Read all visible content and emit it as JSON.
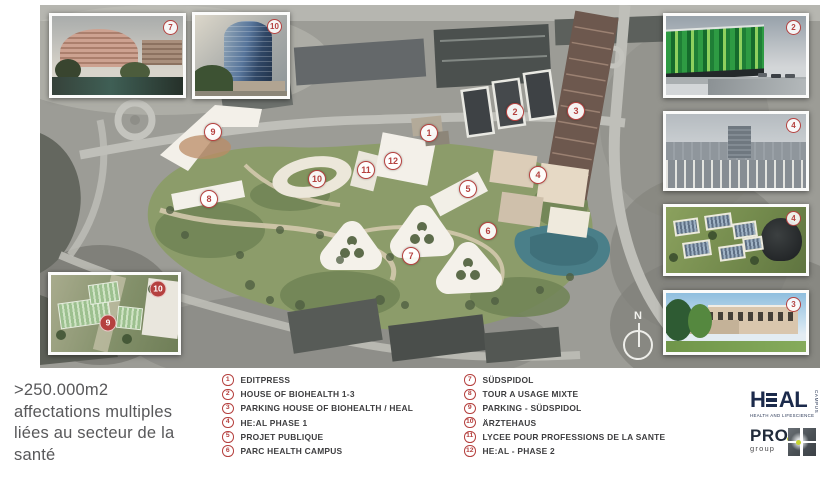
{
  "headline": ">250.000m2 affectations multiples liées au secteur de la santé",
  "legend": {
    "items": [
      {
        "num": "1",
        "label": "EDITPRESS"
      },
      {
        "num": "2",
        "label": "HOUSE OF BIOHEALTH 1-3"
      },
      {
        "num": "3",
        "label": "PARKING HOUSE OF BIOHEALTH / HEAL"
      },
      {
        "num": "4",
        "label": "HE:AL PHASE 1"
      },
      {
        "num": "5",
        "label": "PROJET PUBLIQUE"
      },
      {
        "num": "6",
        "label": "PARC HEALTH CAMPUS"
      },
      {
        "num": "7",
        "label": "SÜDSPIDOL"
      },
      {
        "num": "8",
        "label": "TOUR A USAGE MIXTE"
      },
      {
        "num": "9",
        "label": "PARKING - SÜDSPIDOL"
      },
      {
        "num": "10",
        "label": "ÄRZTEHAUS"
      },
      {
        "num": "11",
        "label": "LYCEE POUR PROFESSIONS DE LA SANTE"
      },
      {
        "num": "12",
        "label": "HE:AL - PHASE 2"
      }
    ]
  },
  "map": {
    "markers": [
      "1",
      "2",
      "3",
      "4",
      "5",
      "6",
      "7",
      "8",
      "9",
      "10",
      "11",
      "12"
    ],
    "compass_label": "N"
  },
  "insets": {
    "sudspidol": {
      "marker": "7"
    },
    "arztehaus": {
      "marker": "10"
    },
    "biohealth": {
      "marker": "2"
    },
    "heal_phase1": {
      "marker": "4"
    },
    "campus_aerial": {
      "marker": "4"
    },
    "parking": {
      "marker": "3"
    },
    "parking_sudspidol": {
      "marker_9": "9",
      "marker_10": "10"
    }
  },
  "logos": {
    "heal": {
      "pre": "H",
      "post": "AL",
      "subtitle": "HEALTH AND LIFESCIENCE",
      "vertical": "CAMPUS"
    },
    "pro": {
      "word": "PRO",
      "sub": "group"
    }
  },
  "colors": {
    "accent_red": "#b5413f",
    "heal_navy": "#1b2a4b",
    "pro_yellow": "#c6d42f",
    "campus_green": "#8c9c6a",
    "pond_teal": "#4a7f89"
  }
}
